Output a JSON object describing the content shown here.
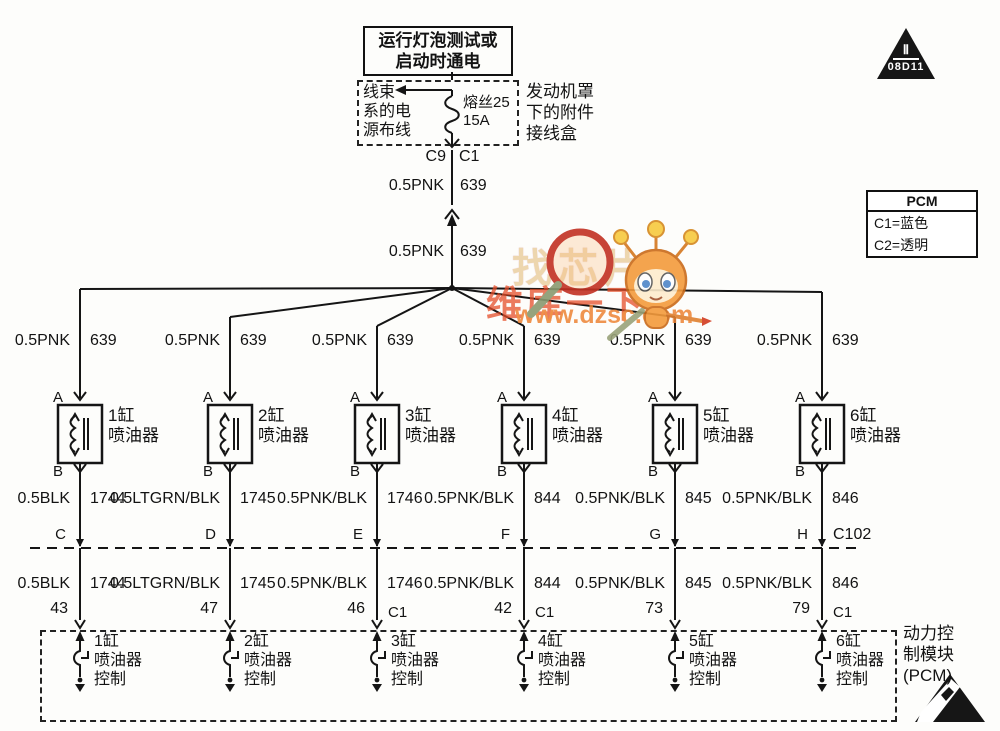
{
  "title_box": {
    "text": "运行灯泡测试或\n启动时通电"
  },
  "fuse_box": {
    "left_label": "线束\n系的电\n源布线",
    "fuse_label": "熔丝25\n15A",
    "right_label": "发动机罩\n下的附件\n接线盒"
  },
  "feed": {
    "connector_left": "C9",
    "connector_right": "C1",
    "segment1": {
      "gauge": "0.5PNK",
      "circuit": "639"
    },
    "segment2": {
      "gauge": "0.5PNK",
      "circuit": "639"
    }
  },
  "ref_triangle": {
    "line1": "Ⅱ",
    "line2": "08D11"
  },
  "pcm_legend": {
    "title": "PCM",
    "row1": "C1=蓝色",
    "row2": "C2=透明"
  },
  "pcm_module_label": "动力控\n制模块\n(PCM)",
  "watermark": {
    "line1": "找芯片",
    "line2": "维库一下",
    "line3": "www.dzsc.com"
  },
  "colors": {
    "line": "#151515",
    "watermark_red": "#e64c28",
    "watermark_orange": "#ee8435"
  },
  "columns": [
    {
      "supply_gauge": "0.5PNK",
      "supply_circuit": "639",
      "term_a": "A",
      "term_b": "B",
      "injector_name": "1缸\n喷油器",
      "wire_gauge": "0.5BLK",
      "wire_circuit": "1744",
      "conn_letter": "C",
      "conn_label": "",
      "pin": "43",
      "pin_conn": "",
      "driver_label": "1缸\n喷油器\n控制"
    },
    {
      "supply_gauge": "0.5PNK",
      "supply_circuit": "639",
      "term_a": "A",
      "term_b": "B",
      "injector_name": "2缸\n喷油器",
      "wire_gauge": "0.5LTGRN/BLK",
      "wire_circuit": "1745",
      "conn_letter": "D",
      "conn_label": "",
      "pin": "47",
      "pin_conn": "",
      "driver_label": "2缸\n喷油器\n控制"
    },
    {
      "supply_gauge": "0.5PNK",
      "supply_circuit": "639",
      "term_a": "A",
      "term_b": "B",
      "injector_name": "3缸\n喷油器",
      "wire_gauge": "0.5PNK/BLK",
      "wire_circuit": "1746",
      "conn_letter": "E",
      "conn_label": "",
      "pin": "46",
      "pin_conn": "C1",
      "driver_label": "3缸\n喷油器\n控制"
    },
    {
      "supply_gauge": "0.5PNK",
      "supply_circuit": "639",
      "term_a": "A",
      "term_b": "B",
      "injector_name": "4缸\n喷油器",
      "wire_gauge": "0.5PNK/BLK",
      "wire_circuit": "844",
      "conn_letter": "F",
      "conn_label": "",
      "pin": "42",
      "pin_conn": "C1",
      "driver_label": "4缸\n喷油器\n控制"
    },
    {
      "supply_gauge": "0.5PNK",
      "supply_circuit": "639",
      "term_a": "A",
      "term_b": "B",
      "injector_name": "5缸\n喷油器",
      "wire_gauge": "0.5PNK/BLK",
      "wire_circuit": "845",
      "conn_letter": "G",
      "conn_label": "",
      "pin": "73",
      "pin_conn": "",
      "driver_label": "5缸\n喷油器\n控制"
    },
    {
      "supply_gauge": "0.5PNK",
      "supply_circuit": "639",
      "term_a": "A",
      "term_b": "B",
      "injector_name": "6缸\n喷油器",
      "wire_gauge": "0.5PNK/BLK",
      "wire_circuit": "846",
      "conn_letter": "H",
      "conn_label": "C102",
      "pin": "79",
      "pin_conn": "C1",
      "driver_label": "6缸\n喷油器\n控制"
    }
  ]
}
